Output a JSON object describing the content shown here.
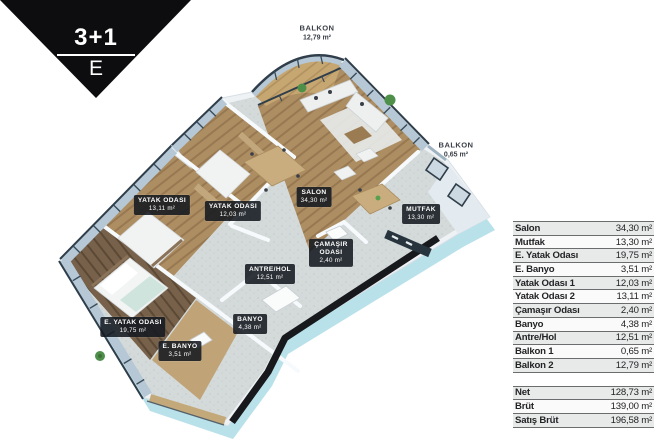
{
  "badge": {
    "type_label": "3+1",
    "block_label": "E"
  },
  "plan": {
    "room_labels": [
      {
        "name": "BALKON",
        "area": "12,79 m²"
      },
      {
        "name": "BALKON",
        "area": "0,65 m²"
      },
      {
        "name": "YATAK ODASI",
        "area": "13,11 m²"
      },
      {
        "name": "YATAK ODASI",
        "area": "12,03 m²"
      },
      {
        "name": "SALON",
        "area": "34,30 m²"
      },
      {
        "name": "MUTFAK",
        "area": "13,30 m²"
      },
      {
        "name": "ÇAMAŞIR ODASI",
        "area": "2,40 m²"
      },
      {
        "name": "ANTRE/HOL",
        "area": "12,51 m²"
      },
      {
        "name": "BANYO",
        "area": "4,38 m²"
      },
      {
        "name": "E. YATAK ODASI",
        "area": "19,75 m²"
      },
      {
        "name": "E. BANYO",
        "area": "3,51 m²"
      }
    ]
  },
  "area_table": {
    "rows": [
      {
        "label": "Salon",
        "value": "34,30 m²"
      },
      {
        "label": "Mutfak",
        "value": "13,30 m²"
      },
      {
        "label": "E. Yatak Odası",
        "value": "19,75 m²"
      },
      {
        "label": "E. Banyo",
        "value": "3,51 m²"
      },
      {
        "label": "Yatak Odası 1",
        "value": "12,03 m²"
      },
      {
        "label": "Yatak Odası 2",
        "value": "13,11 m²"
      },
      {
        "label": "Çamaşır Odası",
        "value": "2,40 m²"
      },
      {
        "label": "Banyo",
        "value": "4,38 m²"
      },
      {
        "label": "Antre/Hol",
        "value": "12,51 m²"
      },
      {
        "label": "Balkon 1",
        "value": "0,65 m²"
      },
      {
        "label": "Balkon 2",
        "value": "12,79 m²"
      }
    ],
    "summary": [
      {
        "label": "Net",
        "value": "128,73 m²"
      },
      {
        "label": "Brüt",
        "value": "139,00 m²"
      },
      {
        "label": "Satış Brüt",
        "value": "196,58 m²"
      }
    ]
  },
  "colors": {
    "badge_bg": "#0d0d0f",
    "wall": "#eef2f5",
    "glass": "#b6c8d6",
    "frame_dark": "#2f3e4a",
    "cut_wall_black": "#17191c",
    "slab_side": "#b5dfe9",
    "wood_light": "#ad8d62",
    "wood_dark": "#77614a",
    "tile": "#d4dada"
  }
}
